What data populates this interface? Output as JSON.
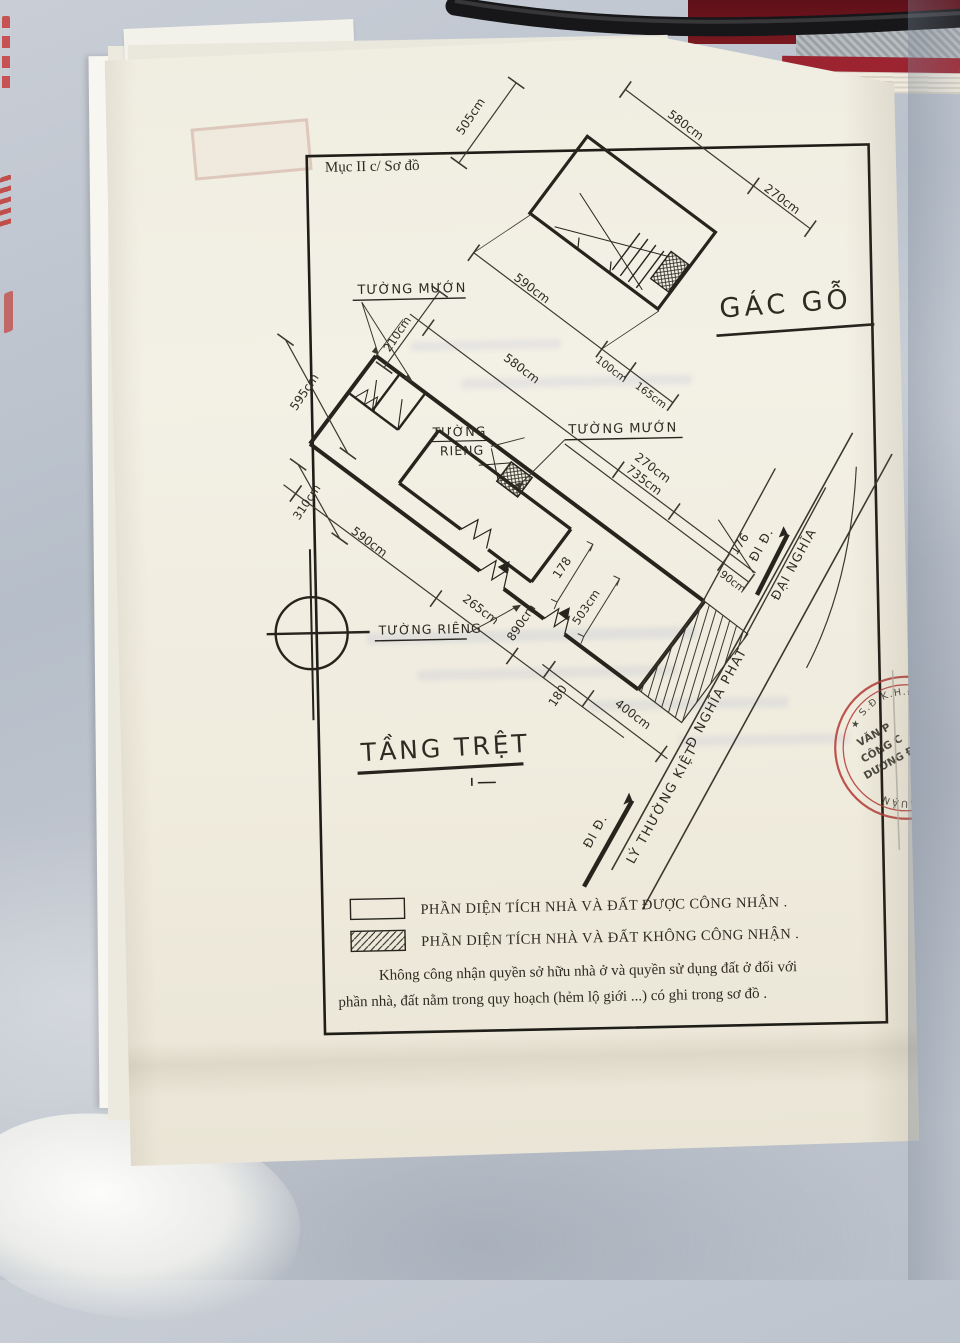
{
  "header": {
    "section": "Mục II c/ Sơ đồ"
  },
  "titles": {
    "attic": "GÁC GỖ",
    "ground": "TẦNG TRỆT"
  },
  "attic_dims": {
    "a505": "505cm",
    "a580": "580cm",
    "a270": "270cm",
    "a590": "590cm",
    "a100": "100cm",
    "a165": "165cm"
  },
  "ground_labels": {
    "wall_rented_top": "TƯỜNG MƯỚN",
    "wall_rented_right": "TƯỜNG MƯỚN",
    "wall_private_line1": "TƯỜNG",
    "wall_private_line2": "RIÊNG",
    "wall_private_bottom": "TƯỜNG RIÊNG"
  },
  "ground_dims": {
    "g210": "210cm",
    "g580": "580cm",
    "g270": "270cm",
    "g595": "595cm",
    "g310": "310cm",
    "g735": "735cm",
    "g90": "90cm",
    "g176": "176",
    "g590": "590cm",
    "g265": "265cm",
    "g178": "178",
    "g503": "503cm",
    "g890": "890cm",
    "g180": "180",
    "g400": "400cm"
  },
  "streets": {
    "go_left": "ĐI Đ.",
    "ly_thuong_kiet": "LÝ THƯỜNG KIỆT",
    "nghia_phat": "Đ NGHĨA PHÁT",
    "go_right": "ĐI Đ.",
    "dai_nghia": "ĐẠI NGHĨA"
  },
  "legend": {
    "recognized": "PHẦN DIỆN TÍCH NHÀ VÀ ĐẤT ĐƯỢC CÔNG NHẬN .",
    "not_recognized": "PHẦN DIỆN TÍCH NHÀ VÀ ĐẤT KHÔNG CÔNG NHẬN .",
    "note1": "Không công nhận quyền sở hữu nhà ở và quyền sử dụng đất ở đối với",
    "note2": "phần nhà, đất nằm trong quy hoạch (hẻm lộ giới ...) có ghi trong sơ đồ ."
  },
  "stamp": {
    "arc_top": "★ S.Đ.K.H.Đ. #102",
    "arc_bottom": "PHÚ NHUẬN",
    "center1": "VĂN P",
    "center2": "CÔNG C",
    "center3": "DƯƠNG Đ",
    "color": "#b43a35"
  },
  "colors": {
    "ink": "#26241d",
    "paper": "#f0ede1",
    "stamp_red": "#b43a35"
  }
}
